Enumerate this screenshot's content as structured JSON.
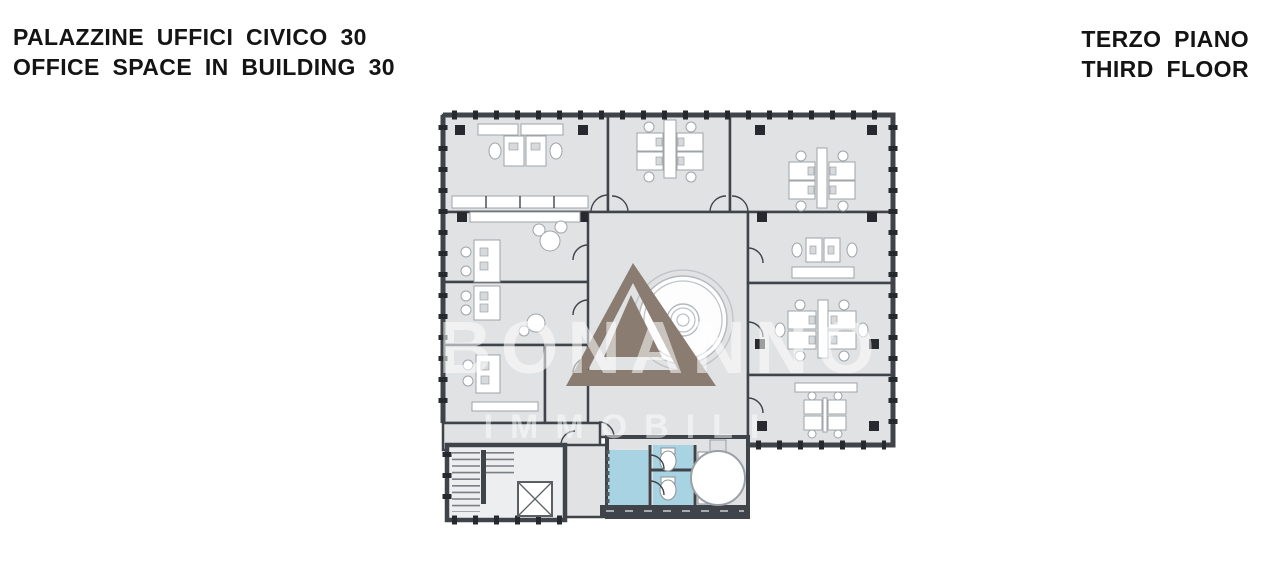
{
  "header_left": {
    "line1": "PALAZZINE UFFICI CIVICO 30",
    "line2": "OFFICE SPACE IN BUILDING 30"
  },
  "header_right": {
    "line1": "TERZO PIANO",
    "line2": "THIRD FLOOR"
  },
  "floor_plan": {
    "description": "Third-floor office plan: nine offices with desk clusters around a central atrium with circular feature, stairwell, elevator and WC block",
    "watermark": {
      "brand": "BONANNO",
      "subtitle": "IMMOBILI",
      "logo": "triangle-logo"
    }
  },
  "colors": {
    "title-text": "#141414",
    "wall": "#3f444a",
    "room-fill": "#e0e2e4",
    "wc-blue": "#a8d3e2",
    "logo-taupe": "#8a7c70",
    "watermark": "#ffffff"
  }
}
